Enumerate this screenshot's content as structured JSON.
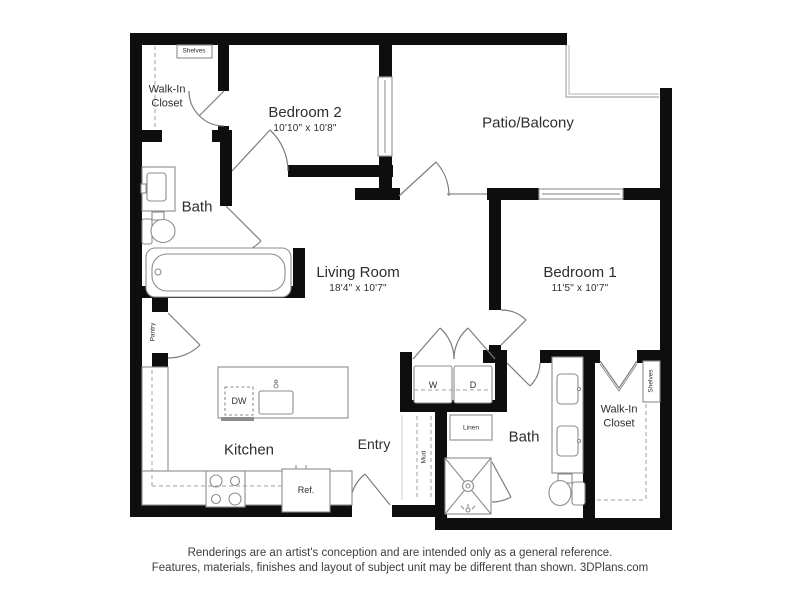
{
  "footer": {
    "line1": "Renderings are an artist's conception and are intended only as a general reference.",
    "line2": "Features, materials, finishes and layout of subject unit may be different than shown. 3DPlans.com"
  },
  "rooms": {
    "walkin_left": {
      "name": "Walk-In Closet"
    },
    "bedroom2": {
      "name": "Bedroom 2",
      "dims": "10'10\" x 10'8\""
    },
    "patio": {
      "name": "Patio/Balcony"
    },
    "bath_left": {
      "name": "Bath"
    },
    "living": {
      "name": "Living Room",
      "dims": "18'4\" x 10'7\""
    },
    "bedroom1": {
      "name": "Bedroom 1",
      "dims": "11'5\" x 10'7\""
    },
    "kitchen": {
      "name": "Kitchen"
    },
    "entry": {
      "name": "Entry"
    },
    "bath_right": {
      "name": "Bath"
    },
    "walkin_right": {
      "name": "Walk-In Closet"
    }
  },
  "fixtures": {
    "shelves_left": "Shelves",
    "shelves_right": "Shelves",
    "pantry": "Pantry",
    "mud": "Mud",
    "linen": "Linen",
    "washer": "W",
    "dryer": "D",
    "dishwasher": "DW",
    "refrigerator": "Ref."
  },
  "colors": {
    "wall": "#0e0e0e",
    "fixture_line": "#8c8c8c",
    "text": "#2e2e2e"
  }
}
